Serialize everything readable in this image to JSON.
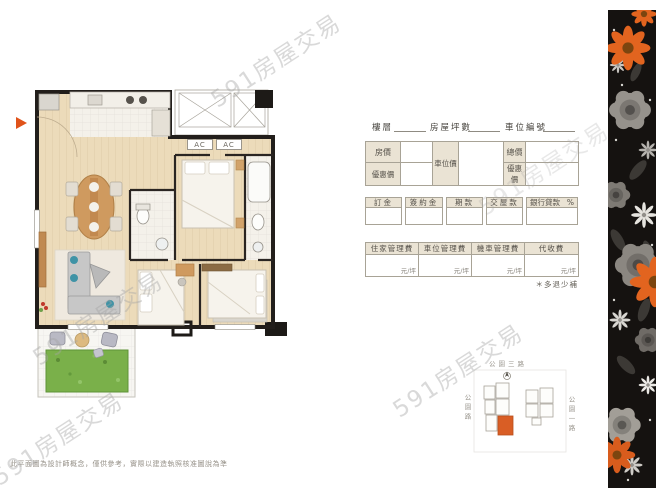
{
  "watermark": {
    "text": "591房屋交易"
  },
  "floor_plan": {
    "ac_labels": [
      "AC",
      "AC"
    ],
    "disclaimer": "此平面圖為設計師概念，僅供參考，實際以建造執照核准圖說為準"
  },
  "form": {
    "header_fields": [
      {
        "label": "樓層"
      },
      {
        "label": "房屋坪數"
      },
      {
        "label": "車位編號"
      }
    ],
    "price_table": {
      "house_price": "房價",
      "house_discount": "優惠價",
      "parking_price": "車位價",
      "total_price": "總價",
      "total_discount": "優惠價"
    },
    "payment_boxes": [
      {
        "label": "訂金"
      },
      {
        "label": "簽約金"
      },
      {
        "label": "期款"
      },
      {
        "label": "交屋款"
      },
      {
        "label": "銀行貸款",
        "suffix": "%"
      }
    ],
    "fee_table": {
      "headers": [
        "住家管理費",
        "車位管理費",
        "機車管理費",
        "代收費"
      ],
      "unit": "元/坪",
      "note": "＊多退少補"
    }
  },
  "site_plan": {
    "road_top": "公園三路",
    "road_left": "公園路",
    "road_right": "公園一路"
  },
  "colors": {
    "accent_orange": "#d95e25",
    "label_beige": "#eae3d4",
    "grass_green": "#7ab04a",
    "wall_black": "#221e1b"
  }
}
